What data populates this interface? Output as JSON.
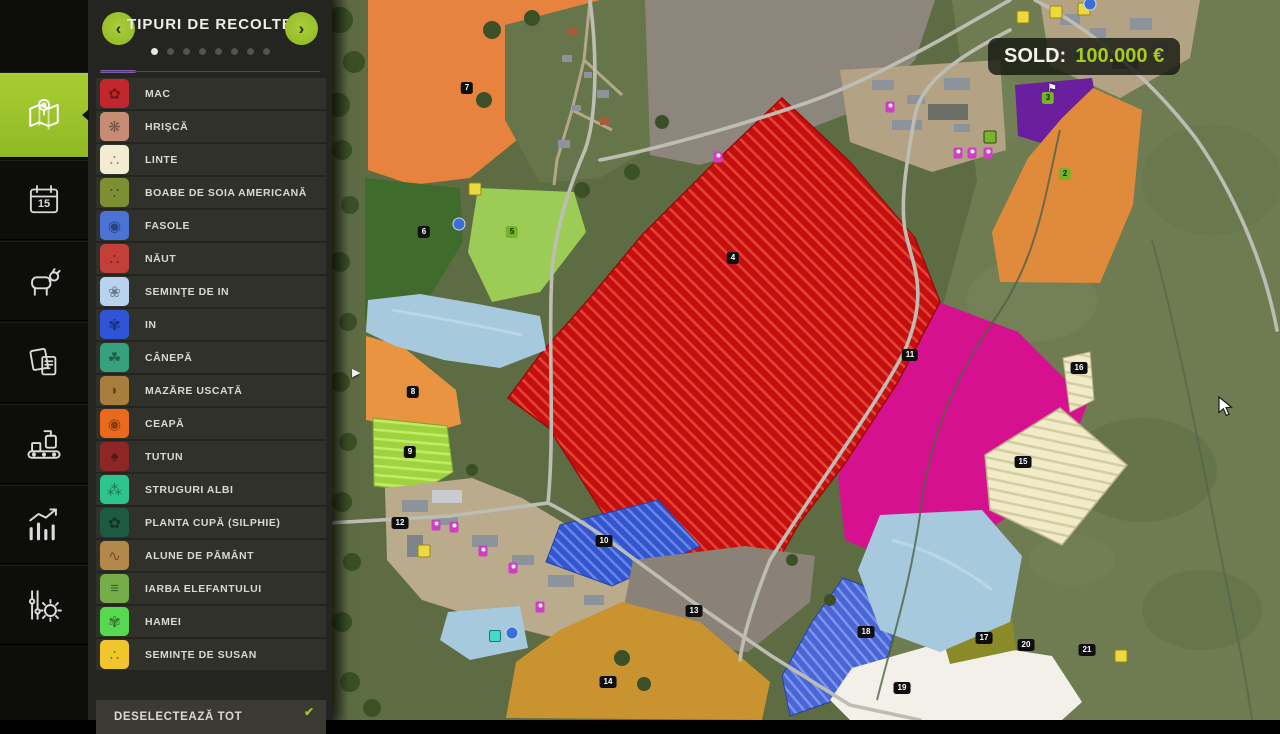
{
  "sidebar": {
    "calendar_day": "15",
    "items": [
      {
        "id": "map",
        "active": true
      },
      {
        "id": "calendar",
        "active": false
      },
      {
        "id": "animals",
        "active": false
      },
      {
        "id": "contracts",
        "active": false
      },
      {
        "id": "production",
        "active": false
      },
      {
        "id": "statistics",
        "active": false
      },
      {
        "id": "settings",
        "active": false
      }
    ]
  },
  "panel": {
    "title": "TIPURI DE RECOLTE",
    "prev_arrow": "‹",
    "next_arrow": "›",
    "pagination": {
      "count": 8,
      "active": 0
    },
    "crops": [
      {
        "label": "MAC",
        "color": "#c1272d",
        "glyph": "✿"
      },
      {
        "label": "HRIŞCĂ",
        "color": "#c68d74",
        "glyph": "❋"
      },
      {
        "label": "LINTE",
        "color": "#f3ecd2",
        "glyph": "∴"
      },
      {
        "label": "BOABE DE SOIA AMERICANĂ",
        "color": "#7e8f33",
        "glyph": "∵"
      },
      {
        "label": "FASOLE",
        "color": "#4a73d4",
        "glyph": "◉"
      },
      {
        "label": "NĂUT",
        "color": "#c24038",
        "glyph": "∴"
      },
      {
        "label": "SEMINŢE DE IN",
        "color": "#b9d2ee",
        "glyph": "❀"
      },
      {
        "label": "IN",
        "color": "#2f55d6",
        "glyph": "✾"
      },
      {
        "label": "CÂNEPĂ",
        "color": "#37a17e",
        "glyph": "☘"
      },
      {
        "label": "MAZĂRE USCATĂ",
        "color": "#a87e3e",
        "glyph": "◗"
      },
      {
        "label": "CEAPĂ",
        "color": "#e96a1d",
        "glyph": "◉"
      },
      {
        "label": "TUTUN",
        "color": "#8e2723",
        "glyph": "♠"
      },
      {
        "label": "STRUGURI ALBI",
        "color": "#2ec490",
        "glyph": "⁂"
      },
      {
        "label": "PLANTA CUPĂ (SILPHIE)",
        "color": "#1d5a41",
        "glyph": "✿"
      },
      {
        "label": "ALUNE DE PĂMÂNT",
        "color": "#b3894a",
        "glyph": "∿"
      },
      {
        "label": "IARBA ELEFANTULUI",
        "color": "#74ad4a",
        "glyph": "≡"
      },
      {
        "label": "HAMEI",
        "color": "#58d84e",
        "glyph": "✾"
      },
      {
        "label": "SEMINŢE DE SUSAN",
        "color": "#f0c62c",
        "glyph": "∴"
      }
    ],
    "deselect_label": "DESELECTEAZĂ TOT",
    "deselect_glyph": "✔",
    "collapse_glyph": "▶"
  },
  "sold": {
    "label": "SOLD:",
    "value": "100.000 €"
  },
  "map": {
    "fields": [
      {
        "number": "7",
        "x": 135,
        "y": 88,
        "owned": false
      },
      {
        "number": "6",
        "x": 92,
        "y": 232,
        "owned": false
      },
      {
        "number": "5",
        "x": 180,
        "y": 232,
        "owned": true
      },
      {
        "number": "4",
        "x": 401,
        "y": 258,
        "owned": false
      },
      {
        "number": "8",
        "x": 81,
        "y": 392,
        "owned": false
      },
      {
        "number": "9",
        "x": 78,
        "y": 452,
        "owned": false
      },
      {
        "number": "12",
        "x": 68,
        "y": 523,
        "owned": false
      },
      {
        "number": "10",
        "x": 272,
        "y": 541,
        "owned": false
      },
      {
        "number": "13",
        "x": 362,
        "y": 611,
        "owned": false
      },
      {
        "number": "14",
        "x": 276,
        "y": 682,
        "owned": false
      },
      {
        "number": "11",
        "x": 578,
        "y": 355,
        "owned": false
      },
      {
        "number": "2",
        "x": 733,
        "y": 174,
        "owned": true
      },
      {
        "number": "3",
        "x": 716,
        "y": 98,
        "owned": true
      },
      {
        "number": "18",
        "x": 534,
        "y": 632,
        "owned": false
      },
      {
        "number": "19",
        "x": 570,
        "y": 688,
        "owned": false
      },
      {
        "number": "15",
        "x": 691,
        "y": 462,
        "owned": false
      },
      {
        "number": "16",
        "x": 747,
        "y": 368,
        "owned": false
      },
      {
        "number": "17",
        "x": 652,
        "y": 638,
        "owned": false
      },
      {
        "number": "20",
        "x": 694,
        "y": 645,
        "owned": false
      },
      {
        "number": "21",
        "x": 755,
        "y": 650,
        "owned": false
      }
    ],
    "markers": [
      {
        "type": "shop",
        "x": 691,
        "y": 17
      },
      {
        "type": "shop",
        "x": 724,
        "y": 12
      },
      {
        "type": "shop",
        "x": 752,
        "y": 9
      },
      {
        "type": "shop",
        "x": 143,
        "y": 189
      },
      {
        "type": "shop",
        "x": 92,
        "y": 551
      },
      {
        "type": "shop",
        "x": 789,
        "y": 656
      },
      {
        "type": "person",
        "x": 104,
        "y": 525
      },
      {
        "type": "person",
        "x": 122,
        "y": 527
      },
      {
        "type": "person",
        "x": 151,
        "y": 551
      },
      {
        "type": "person",
        "x": 181,
        "y": 568
      },
      {
        "type": "person",
        "x": 208,
        "y": 607
      },
      {
        "type": "person",
        "x": 626,
        "y": 153
      },
      {
        "type": "person",
        "x": 640,
        "y": 153
      },
      {
        "type": "person",
        "x": 656,
        "y": 153
      },
      {
        "type": "person",
        "x": 558,
        "y": 107
      },
      {
        "type": "person",
        "x": 386,
        "y": 157
      },
      {
        "type": "blue",
        "x": 127,
        "y": 224
      },
      {
        "type": "blue",
        "x": 180,
        "y": 633
      },
      {
        "type": "blue",
        "x": 758,
        "y": 4
      },
      {
        "type": "cyan",
        "x": 163,
        "y": 636
      },
      {
        "type": "green",
        "x": 658,
        "y": 137
      },
      {
        "type": "flag",
        "x": 720,
        "y": 88,
        "glyph": "⚑"
      }
    ]
  }
}
